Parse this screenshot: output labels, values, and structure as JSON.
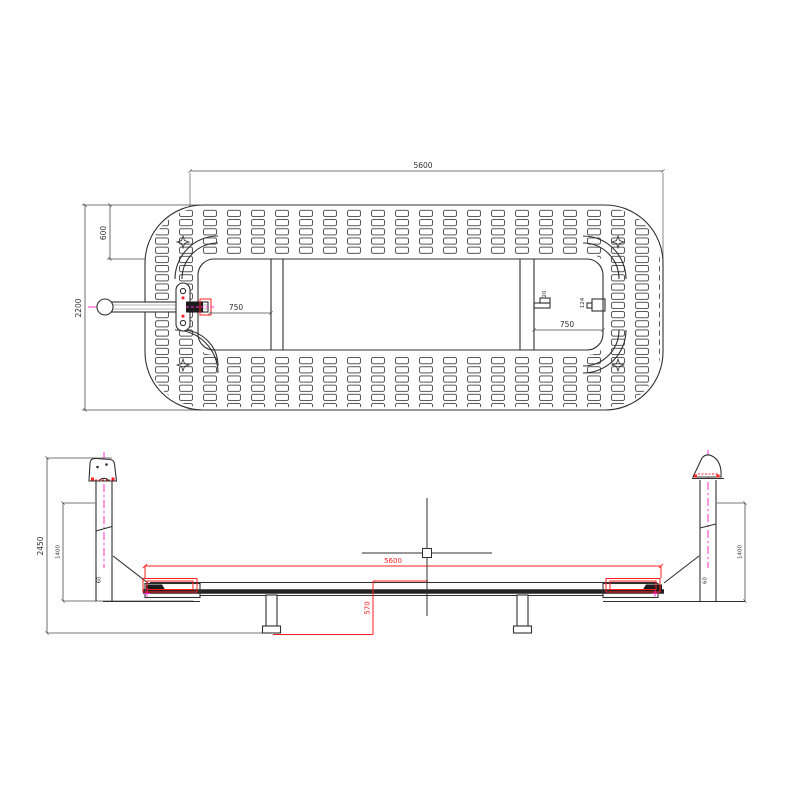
{
  "app": {
    "canvas_background": "#ffffff"
  },
  "colors": {
    "line": "#303030",
    "dimension": "#4a4a4a",
    "overlay_red": "#ff1f1f",
    "centerline_magenta": "#ff2ed2"
  },
  "plan_view": {
    "dims": {
      "overall_length": "5600",
      "end_offset": "600",
      "overall_width": "2200",
      "left_spacing": "750",
      "right_spacing": "750",
      "bracket_small": "20",
      "bracket_large": "124"
    }
  },
  "elevation_view": {
    "dims": {
      "overall_height": "2450",
      "post_height_left": "1400",
      "post_height_right": "1400",
      "base_offset_left": "60",
      "base_offset_right": "60",
      "deck_length": "5600",
      "leg_drop": "570"
    }
  }
}
